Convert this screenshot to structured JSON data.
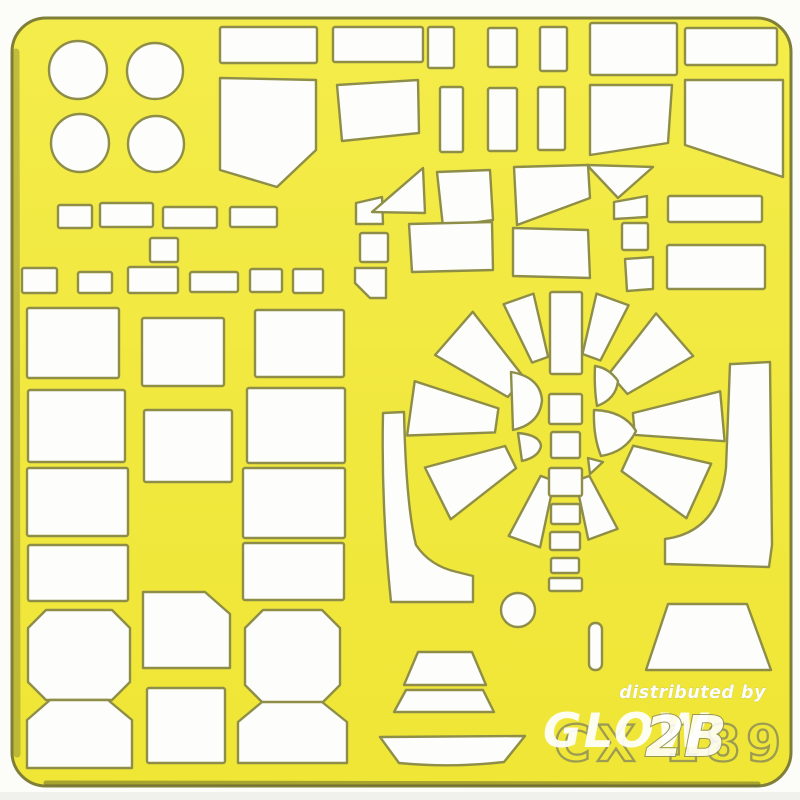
{
  "photo": {
    "description": "Yellow die-cut scale-model paint mask sheet, code CX 189, with white cut-out mask shapes",
    "sheet_code": "CX 189",
    "watermark_line": "distributed by",
    "watermark_logo": "GLOW",
    "watermark_logo2": "2B",
    "colors": {
      "background": "#fcfcf9",
      "sheet_top": "#f4ec4a",
      "sheet_bottom": "#efe636",
      "sheet_edge": "#7f7f3a",
      "cut_fill": "#fdfdfb",
      "cut_outline": "#8e8e48",
      "etched_text": "#8f8f58",
      "watermark": "#ffffff"
    }
  },
  "svg": {
    "width": 800,
    "height": 800,
    "sheet": {
      "x": 12,
      "y": 18,
      "w": 779,
      "h": 768,
      "rx": 34
    },
    "shapes": [
      {
        "n": "porthole-circle-1",
        "t": "circle",
        "cx": 78,
        "cy": 70,
        "r": 29
      },
      {
        "n": "porthole-circle-2",
        "t": "circle",
        "cx": 155,
        "cy": 71,
        "r": 28
      },
      {
        "n": "porthole-circle-3",
        "t": "circle",
        "cx": 80,
        "cy": 143,
        "r": 29
      },
      {
        "n": "porthole-circle-4",
        "t": "circle",
        "cx": 156,
        "cy": 144,
        "r": 28
      },
      {
        "n": "panel-rect",
        "t": "rect",
        "x": 220,
        "y": 27,
        "w": 97,
        "h": 36
      },
      {
        "n": "panel-rect",
        "t": "rect",
        "x": 333,
        "y": 27,
        "w": 90,
        "h": 35
      },
      {
        "n": "windscreen-panel",
        "t": "poly",
        "p": [
          [
            220,
            78
          ],
          [
            316,
            80
          ],
          [
            316,
            150
          ],
          [
            277,
            187
          ],
          [
            220,
            170
          ]
        ]
      },
      {
        "n": "window-quad",
        "t": "poly",
        "p": [
          [
            337,
            85
          ],
          [
            418,
            80
          ],
          [
            419,
            133
          ],
          [
            342,
            141
          ]
        ]
      },
      {
        "n": "slot-rect",
        "t": "rect",
        "x": 428,
        "y": 27,
        "w": 26,
        "h": 41
      },
      {
        "n": "slot-rect",
        "t": "rect",
        "x": 488,
        "y": 28,
        "w": 29,
        "h": 39
      },
      {
        "n": "slot-rect",
        "t": "rect",
        "x": 540,
        "y": 27,
        "w": 27,
        "h": 44
      },
      {
        "n": "panel-rect",
        "t": "rect",
        "x": 590,
        "y": 23,
        "w": 87,
        "h": 52
      },
      {
        "n": "panel-rect",
        "t": "rect",
        "x": 685,
        "y": 28,
        "w": 92,
        "h": 37
      },
      {
        "n": "slot-rect",
        "t": "rect",
        "x": 440,
        "y": 87,
        "w": 23,
        "h": 65
      },
      {
        "n": "slot-rect",
        "t": "rect",
        "x": 488,
        "y": 88,
        "w": 29,
        "h": 63
      },
      {
        "n": "slot-rect",
        "t": "rect",
        "x": 538,
        "y": 87,
        "w": 27,
        "h": 63
      },
      {
        "n": "window-quad",
        "t": "poly",
        "p": [
          [
            590,
            85
          ],
          [
            672,
            85
          ],
          [
            668,
            143
          ],
          [
            590,
            155
          ]
        ]
      },
      {
        "n": "canopy-pentagon",
        "t": "poly",
        "p": [
          [
            685,
            80
          ],
          [
            783,
            80
          ],
          [
            783,
            177
          ],
          [
            685,
            145
          ]
        ]
      },
      {
        "n": "tab-rect",
        "t": "rect",
        "x": 58,
        "y": 205,
        "w": 34,
        "h": 23
      },
      {
        "n": "tab-rect",
        "t": "rect",
        "x": 100,
        "y": 203,
        "w": 53,
        "h": 24
      },
      {
        "n": "tab-rect",
        "t": "rect",
        "x": 163,
        "y": 207,
        "w": 54,
        "h": 21
      },
      {
        "n": "tab-rect",
        "t": "rect",
        "x": 230,
        "y": 207,
        "w": 47,
        "h": 20
      },
      {
        "n": "tab-rect",
        "t": "rect",
        "x": 150,
        "y": 238,
        "w": 28,
        "h": 24
      },
      {
        "n": "tab-rect",
        "t": "rect",
        "x": 22,
        "y": 268,
        "w": 35,
        "h": 25
      },
      {
        "n": "tab-rect",
        "t": "rect",
        "x": 78,
        "y": 272,
        "w": 34,
        "h": 21
      },
      {
        "n": "tab-rect",
        "t": "rect",
        "x": 128,
        "y": 267,
        "w": 50,
        "h": 26
      },
      {
        "n": "tab-rect",
        "t": "rect",
        "x": 190,
        "y": 272,
        "w": 48,
        "h": 20
      },
      {
        "n": "tab-rect",
        "t": "rect",
        "x": 250,
        "y": 269,
        "w": 32,
        "h": 23
      },
      {
        "n": "tab-rect",
        "t": "rect",
        "x": 293,
        "y": 269,
        "w": 30,
        "h": 24
      },
      {
        "n": "flag-quad",
        "t": "poly",
        "p": [
          [
            356,
            203
          ],
          [
            382,
            197
          ],
          [
            383,
            224
          ],
          [
            356,
            224
          ]
        ]
      },
      {
        "n": "tab-rect",
        "t": "rect",
        "x": 360,
        "y": 233,
        "w": 28,
        "h": 29
      },
      {
        "n": "notched-quad",
        "t": "poly",
        "p": [
          [
            355,
            268
          ],
          [
            386,
            268
          ],
          [
            386,
            298
          ],
          [
            370,
            298
          ],
          [
            355,
            283
          ]
        ]
      },
      {
        "n": "glazing-triangle",
        "t": "poly",
        "p": [
          [
            372,
            212
          ],
          [
            423,
            168
          ],
          [
            425,
            213
          ]
        ]
      },
      {
        "n": "glazing-quad",
        "t": "poly",
        "p": [
          [
            437,
            172
          ],
          [
            490,
            170
          ],
          [
            493,
            220
          ],
          [
            443,
            227
          ]
        ]
      },
      {
        "n": "glazing-quad",
        "t": "poly",
        "p": [
          [
            409,
            224
          ],
          [
            492,
            222
          ],
          [
            493,
            270
          ],
          [
            412,
            272
          ]
        ]
      },
      {
        "n": "glazing-quad",
        "t": "poly",
        "p": [
          [
            514,
            167
          ],
          [
            588,
            165
          ],
          [
            590,
            198
          ],
          [
            517,
            225
          ]
        ]
      },
      {
        "n": "glazing-quad",
        "t": "poly",
        "p": [
          [
            513,
            228
          ],
          [
            588,
            230
          ],
          [
            590,
            278
          ],
          [
            513,
            276
          ]
        ]
      },
      {
        "n": "glazing-triangle-down",
        "t": "poly",
        "p": [
          [
            587,
            165
          ],
          [
            653,
            167
          ],
          [
            618,
            198
          ]
        ]
      },
      {
        "n": "small-trapezoid",
        "t": "poly",
        "p": [
          [
            614,
            202
          ],
          [
            647,
            196
          ],
          [
            647,
            217
          ],
          [
            614,
            219
          ]
        ]
      },
      {
        "n": "tab-rect",
        "t": "rect",
        "x": 622,
        "y": 223,
        "w": 26,
        "h": 27
      },
      {
        "n": "small-quad",
        "t": "poly",
        "p": [
          [
            625,
            259
          ],
          [
            653,
            257
          ],
          [
            653,
            289
          ],
          [
            627,
            291
          ]
        ]
      },
      {
        "n": "panel-rect",
        "t": "rect",
        "x": 668,
        "y": 196,
        "w": 94,
        "h": 26
      },
      {
        "n": "panel-rect",
        "t": "rect",
        "x": 667,
        "y": 245,
        "w": 98,
        "h": 44
      },
      {
        "n": "large-rect",
        "t": "rect",
        "x": 27,
        "y": 308,
        "w": 92,
        "h": 70
      },
      {
        "n": "large-rect",
        "t": "rect",
        "x": 28,
        "y": 390,
        "w": 97,
        "h": 72
      },
      {
        "n": "large-rect",
        "t": "rect",
        "x": 27,
        "y": 468,
        "w": 101,
        "h": 68
      },
      {
        "n": "large-rect",
        "t": "rect",
        "x": 28,
        "y": 545,
        "w": 100,
        "h": 56
      },
      {
        "n": "large-rect",
        "t": "rect",
        "x": 142,
        "y": 318,
        "w": 82,
        "h": 68
      },
      {
        "n": "large-rect",
        "t": "rect",
        "x": 144,
        "y": 410,
        "w": 88,
        "h": 72
      },
      {
        "n": "large-rect",
        "t": "rect",
        "x": 255,
        "y": 310,
        "w": 89,
        "h": 67
      },
      {
        "n": "large-rect",
        "t": "rect",
        "x": 247,
        "y": 388,
        "w": 98,
        "h": 75
      },
      {
        "n": "large-rect",
        "t": "rect",
        "x": 243,
        "y": 468,
        "w": 102,
        "h": 70
      },
      {
        "n": "large-rect",
        "t": "rect",
        "x": 243,
        "y": 543,
        "w": 101,
        "h": 57
      },
      {
        "n": "octagon-panel",
        "t": "poly",
        "p": [
          [
            46,
            610
          ],
          [
            112,
            610
          ],
          [
            130,
            628
          ],
          [
            130,
            682
          ],
          [
            112,
            700
          ],
          [
            46,
            700
          ],
          [
            28,
            682
          ],
          [
            28,
            628
          ]
        ]
      },
      {
        "n": "corner-cut-panel",
        "t": "poly",
        "p": [
          [
            143,
            592
          ],
          [
            205,
            592
          ],
          [
            230,
            614
          ],
          [
            230,
            668
          ],
          [
            143,
            668
          ]
        ]
      },
      {
        "n": "octagon-panel",
        "t": "poly",
        "p": [
          [
            263,
            610
          ],
          [
            322,
            610
          ],
          [
            340,
            628
          ],
          [
            340,
            685
          ],
          [
            322,
            703
          ],
          [
            263,
            703
          ],
          [
            245,
            685
          ],
          [
            245,
            628
          ]
        ]
      },
      {
        "n": "tub-panel",
        "t": "poly",
        "p": [
          [
            27,
            720
          ],
          [
            50,
            700
          ],
          [
            108,
            700
          ],
          [
            132,
            720
          ],
          [
            132,
            768
          ],
          [
            27,
            768
          ]
        ]
      },
      {
        "n": "large-rect",
        "t": "rect",
        "x": 147,
        "y": 688,
        "w": 78,
        "h": 75
      },
      {
        "n": "tub-panel",
        "t": "poly",
        "p": [
          [
            238,
            722
          ],
          [
            262,
            702
          ],
          [
            322,
            702
          ],
          [
            347,
            722
          ],
          [
            347,
            763
          ],
          [
            238,
            763
          ]
        ]
      },
      {
        "n": "cowl-wedge",
        "t": "sector",
        "a1": -26,
        "a2": -13,
        "r1": 75,
        "r2": 140
      },
      {
        "n": "cowl-wedge",
        "t": "sector",
        "a1": 13,
        "a2": 27,
        "r1": 78,
        "r2": 140
      },
      {
        "n": "cowl-wedge",
        "t": "sector",
        "a1": 38,
        "a2": 60,
        "r1": 72,
        "r2": 148
      },
      {
        "n": "cowl-wedge",
        "t": "sector",
        "a1": 76,
        "a2": 94,
        "r1": 70,
        "r2": 160
      },
      {
        "n": "cowl-wedge",
        "t": "sector",
        "a1": 103,
        "a2": 126,
        "r1": 70,
        "r2": 150
      },
      {
        "n": "cowl-wedge",
        "t": "sector",
        "a1": 152,
        "a2": 168,
        "r1": 52,
        "r2": 112
      },
      {
        "n": "cowl-wedge",
        "t": "sector",
        "a1": 192,
        "a2": 208,
        "r1": 52,
        "r2": 120
      },
      {
        "n": "cowl-wedge",
        "t": "sector",
        "a1": 232,
        "a2": 255,
        "r1": 62,
        "r2": 145
      },
      {
        "n": "cowl-wedge",
        "t": "sector",
        "a1": 268,
        "a2": 288,
        "r1": 70,
        "r2": 158
      },
      {
        "n": "cowl-wedge",
        "t": "sector",
        "a1": 300,
        "a2": 322,
        "r1": 66,
        "r2": 150
      },
      {
        "n": "spine-rect",
        "t": "rect",
        "x": 550,
        "y": 292,
        "w": 32,
        "h": 82
      },
      {
        "n": "spine-rect",
        "t": "rect",
        "x": 549,
        "y": 394,
        "w": 33,
        "h": 30
      },
      {
        "n": "spine-rect",
        "t": "rect",
        "x": 551,
        "y": 432,
        "w": 29,
        "h": 26
      },
      {
        "n": "spine-rect",
        "t": "rect",
        "x": 549,
        "y": 468,
        "w": 33,
        "h": 28
      },
      {
        "n": "spine-rect",
        "t": "rect",
        "x": 551,
        "y": 504,
        "w": 29,
        "h": 20
      },
      {
        "n": "spine-rect",
        "t": "rect",
        "x": 550,
        "y": 532,
        "w": 30,
        "h": 18
      },
      {
        "n": "spine-rect",
        "t": "rect",
        "x": 551,
        "y": 558,
        "w": 28,
        "h": 15
      },
      {
        "n": "spine-rect",
        "t": "rect",
        "x": 549,
        "y": 578,
        "w": 33,
        "h": 13
      },
      {
        "n": "hub-lens",
        "t": "path",
        "d": "M511,372 Q540,377 542,400 Q540,424 513,430 Z"
      },
      {
        "n": "hub-lens",
        "t": "path",
        "d": "M518,433 Q540,435 541,446 Q539,457 522,461 Z"
      },
      {
        "n": "hub-lens",
        "t": "path",
        "d": "M595,366 Q594,388 597,406 Q616,399 618,381 Q609,368 595,366 Z"
      },
      {
        "n": "hub-lens",
        "t": "path",
        "d": "M594,410 Q593,436 601,456 Q626,452 636,431 Q624,411 594,410 Z"
      },
      {
        "n": "hub-triangle",
        "t": "poly",
        "p": [
          [
            588,
            458
          ],
          [
            603,
            462
          ],
          [
            590,
            474
          ]
        ]
      },
      {
        "n": "curved-band-left",
        "t": "path",
        "d": "M383,413 L404,412 Q406,505 416,545 Q430,566 457,572 L473,576 L473,602 L391,602 Q381,505 383,413 Z"
      },
      {
        "n": "curved-band-right",
        "t": "path",
        "d": "M733,364 L770,362 L772,545 L769,567 L665,564 L665,539 Q719,532 726,468 L730,364 Z"
      },
      {
        "n": "wheel-circle",
        "t": "circle",
        "cx": 518,
        "cy": 610,
        "r": 17
      },
      {
        "n": "pill-slot",
        "t": "rect",
        "x": 589,
        "y": 623,
        "w": 13,
        "h": 47,
        "rx": 6
      },
      {
        "n": "trapezoid-panel",
        "t": "poly",
        "p": [
          [
            668,
            604
          ],
          [
            747,
            604
          ],
          [
            771,
            670
          ],
          [
            646,
            670
          ]
        ]
      },
      {
        "n": "hull-trapezoid",
        "t": "poly",
        "p": [
          [
            418,
            652
          ],
          [
            472,
            652
          ],
          [
            486,
            685
          ],
          [
            404,
            685
          ]
        ]
      },
      {
        "n": "hull-trapezoid",
        "t": "poly",
        "p": [
          [
            406,
            690
          ],
          [
            483,
            690
          ],
          [
            494,
            712
          ],
          [
            394,
            712
          ]
        ]
      },
      {
        "n": "boat-hull",
        "t": "path",
        "d": "M380,737 L525,736 L504,762 Q452,768 399,763 Z"
      }
    ],
    "fan_center": {
      "cx": 565,
      "cy": 430
    },
    "texts": [
      {
        "n": "sheet-code-text",
        "x": 554,
        "y": 761,
        "text": "CX 189",
        "size": 50,
        "weight": "bold",
        "fill": "none",
        "stroke": "#8f8f58",
        "sw": 2.3,
        "ls": 6,
        "op": 0.85
      },
      {
        "n": "watermark-glow-logo",
        "x": 543,
        "y": 747,
        "text": "GLOW",
        "size": 47,
        "style": "italic",
        "weight": "bold",
        "fill": "#ffffff",
        "op": 0.93,
        "ls": 2
      },
      {
        "n": "watermark-glow-logo-2b",
        "x": 645,
        "y": 756,
        "text": "2B",
        "size": 56,
        "style": "italic",
        "weight": "bold",
        "fill": "#ffffff",
        "op": 0.88,
        "stroke": "#8d8d52",
        "sw": 2
      },
      {
        "n": "watermark-distributed-by",
        "x": 766,
        "y": 698,
        "text": "distributed by",
        "size": 17.5,
        "style": "italic",
        "weight": "bold",
        "fill": "#ffffff",
        "op": 0.97,
        "ls": 0.5,
        "stroke": "#b9b978",
        "sw": 0.5,
        "anchor": "end"
      }
    ]
  }
}
